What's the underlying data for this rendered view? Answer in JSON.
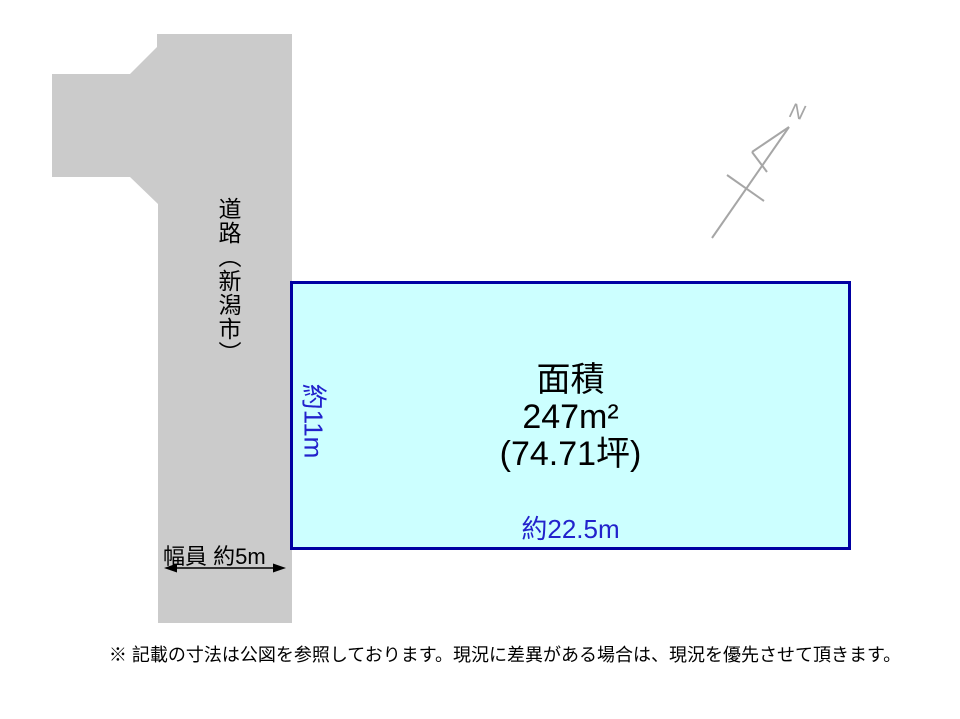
{
  "road": {
    "label": "道路（新潟市）",
    "width_label": "幅員 約5m"
  },
  "parcel": {
    "title": "面積",
    "area_m2": "247m²",
    "area_tsubo": "(74.71坪)",
    "frontage_label": "約22.5m",
    "depth_label": "約11m"
  },
  "compass": {
    "label": "N"
  },
  "footer": {
    "note": "※ 記載の寸法は公図を参照しております。現況に差異がある場合は、現況を優先させて頂きます。"
  },
  "colors": {
    "road_fill": "#cbcbcb",
    "parcel_fill": "#ccffff",
    "parcel_border": "#0000a2",
    "dimension_text": "#2222cc",
    "compass_gray": "#a6a6a6",
    "text_black": "#000000",
    "background": "#ffffff"
  }
}
